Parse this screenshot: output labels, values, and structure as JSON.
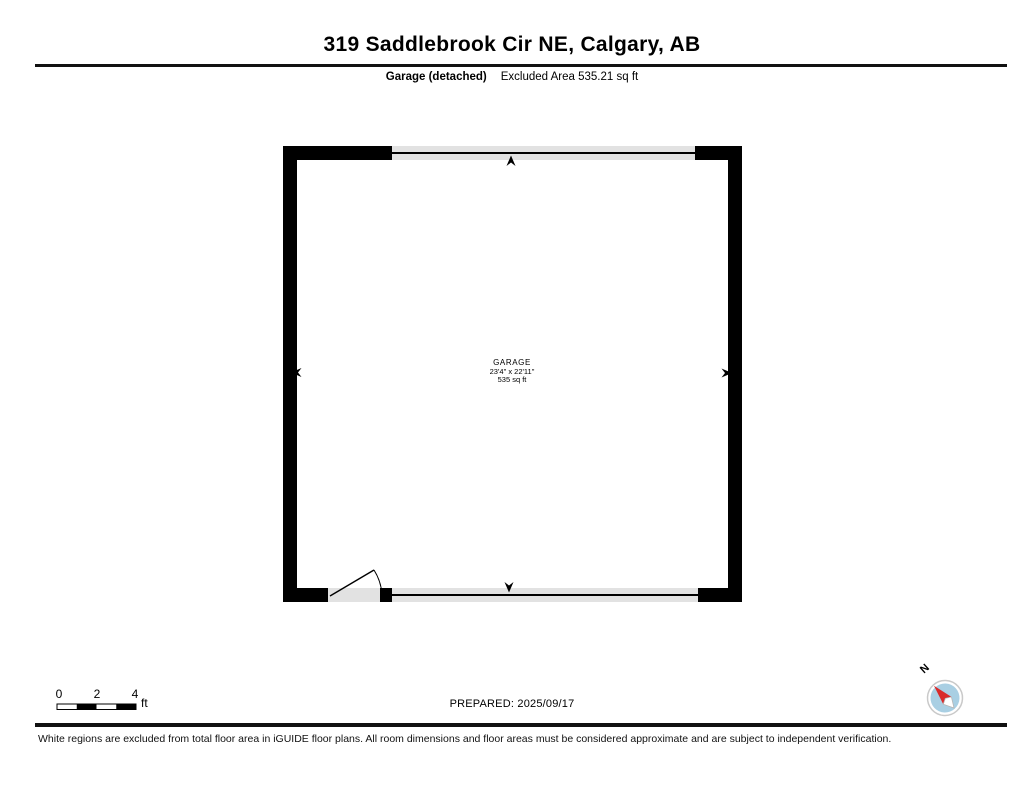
{
  "header": {
    "title": "319 Saddlebrook Cir NE, Calgary, AB",
    "floor_label": "Garage (detached)",
    "area_label": "Excluded Area 535.21 sq ft"
  },
  "room": {
    "name": "GARAGE",
    "dimensions": "23'4\" x 22'11\"",
    "area": "535 sq ft"
  },
  "scale_bar": {
    "ticks": [
      "0",
      "2",
      "4"
    ],
    "unit": "ft"
  },
  "footer": {
    "prepared": "PREPARED: 2025/09/17",
    "disclaimer": "White regions are excluded from total floor area in iGUIDE floor plans. All room dimensions and floor areas must be considered approximate and are subject to independent verification."
  },
  "compass": {
    "label": "N",
    "needle_color": "#d92b2b",
    "face_color": "#a9cfe3",
    "ring_color": "#c9c9c9"
  },
  "colors": {
    "wall": "#000000",
    "opening_fill": "#e2e2e2"
  }
}
